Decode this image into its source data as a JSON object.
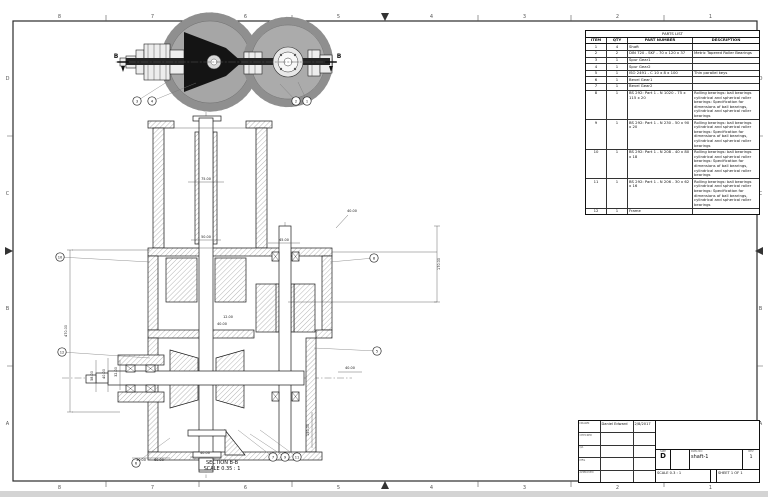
{
  "sheet": {
    "zones_top": [
      "8",
      "7",
      "6",
      "5",
      "4",
      "3",
      "2",
      "1"
    ],
    "zones_side": [
      "D",
      "C",
      "B",
      "A"
    ]
  },
  "top_view": {
    "section_label": "B",
    "balloons": [
      {
        "n": "3",
        "x": 137,
        "y": 101,
        "tx": 170,
        "ty": 80
      },
      {
        "n": "4",
        "x": 152,
        "y": 101,
        "tx": 196,
        "ty": 83
      },
      {
        "n": "2",
        "x": 296,
        "y": 101,
        "tx": 280,
        "ty": 84
      },
      {
        "n": "1",
        "x": 307,
        "y": 101,
        "tx": 298,
        "ty": 82
      }
    ]
  },
  "section_view": {
    "title": "SECTION B-B",
    "scale": "SCALE 0.35 : 1",
    "balloons": [
      {
        "n": "10",
        "x": 60,
        "y": 257,
        "tx": 150,
        "ty": 262
      },
      {
        "n": "12",
        "x": 62,
        "y": 352,
        "tx": 150,
        "ty": 358
      },
      {
        "n": "8",
        "x": 374,
        "y": 258,
        "tx": 330,
        "ty": 262
      },
      {
        "n": "5",
        "x": 377,
        "y": 351,
        "tx": 314,
        "ty": 348
      },
      {
        "n": "7",
        "x": 273,
        "y": 457,
        "tx": 238,
        "ty": 430
      },
      {
        "n": "9",
        "x": 285,
        "y": 457,
        "tx": 250,
        "ty": 434
      },
      {
        "n": "11",
        "x": 297,
        "y": 457,
        "tx": 260,
        "ty": 430
      },
      {
        "n": "6",
        "x": 136,
        "y": 463,
        "tx": 170,
        "ty": 438
      }
    ],
    "dim_labels": [
      {
        "t": "75.00",
        "x": 206,
        "y": 180,
        "r": 0
      },
      {
        "t": "50.00",
        "x": 206,
        "y": 238,
        "r": 0
      },
      {
        "t": "12.00",
        "x": 228,
        "y": 318,
        "r": 0
      },
      {
        "t": "40.00",
        "x": 222,
        "y": 325,
        "r": 0
      },
      {
        "t": "40.00",
        "x": 352,
        "y": 212,
        "r": 0
      },
      {
        "t": "45.00",
        "x": 284,
        "y": 241,
        "r": 0
      },
      {
        "t": "170.00",
        "x": 440,
        "y": 264,
        "r": -90
      },
      {
        "t": "470.00",
        "x": 67,
        "y": 331,
        "r": -90
      },
      {
        "t": "40.00",
        "x": 105,
        "y": 374,
        "r": -90
      },
      {
        "t": "32.00",
        "x": 117,
        "y": 372,
        "r": -90
      },
      {
        "t": "58.00",
        "x": 93,
        "y": 376,
        "r": -90
      },
      {
        "t": "150.00",
        "x": 309,
        "y": 430,
        "r": -90
      },
      {
        "t": "40.00",
        "x": 350,
        "y": 369,
        "r": 0
      },
      {
        "t": "40.00",
        "x": 205,
        "y": 454,
        "r": 0
      },
      {
        "t": "30.00",
        "x": 141,
        "y": 461,
        "r": 0
      },
      {
        "t": "60.00",
        "x": 159,
        "y": 461,
        "r": 0
      }
    ]
  },
  "parts_list": {
    "title": "PARTS LIST",
    "columns": [
      "ITEM",
      "QTY",
      "PART NUMBER",
      "DESCRIPTION"
    ],
    "rows": [
      {
        "item": "1",
        "qty": "4",
        "part_number": "Shaft",
        "description": ""
      },
      {
        "item": "2",
        "qty": "2",
        "part_number": "DIN 720 - SKF - 70 x 120 x 37",
        "description": "Metric Tapered Roller Bearings"
      },
      {
        "item": "3",
        "qty": "1",
        "part_number": "Spur Gear1",
        "description": ""
      },
      {
        "item": "4",
        "qty": "1",
        "part_number": "Spur Gear2",
        "description": ""
      },
      {
        "item": "5",
        "qty": "1",
        "part_number": "ISO 2491 - C 10 x 8 x 100",
        "description": "Thin parallel keys"
      },
      {
        "item": "6",
        "qty": "1",
        "part_number": "Bevel Gear1",
        "description": ""
      },
      {
        "item": "7",
        "qty": "1",
        "part_number": "Bevel Gear2",
        "description": ""
      },
      {
        "item": "8",
        "qty": "1",
        "part_number": "BS 292: Part 1 - N 1020 - 75 x 115 x 20",
        "description": "Rolling bearings: ball bearings cylindrical and spherical roller bearings: Specification for dimensions of ball bearings, cylindrical and spherical roller bearings"
      },
      {
        "item": "9",
        "qty": "1",
        "part_number": "BS 292: Part 1 - N 230 - 50 x 90 x 20",
        "description": "Rolling bearings: ball bearings cylindrical and spherical roller bearings: Specification for dimensions of ball bearings, cylindrical and spherical roller bearings"
      },
      {
        "item": "10",
        "qty": "1",
        "part_number": "BS 292: Part 1 - N 208 - 40 x 80 x 18",
        "description": "Rolling bearings: ball bearings cylindrical and spherical roller bearings: Specification for dimensions of ball bearings, cylindrical and spherical roller bearings"
      },
      {
        "item": "11",
        "qty": "1",
        "part_number": "BS 292: Part 1 - N 206 - 30 x 62 x 16",
        "description": "Rolling bearings: ball bearings cylindrical and spherical roller bearings: Specification for dimensions of ball bearings, cylindrical and spherical roller bearings"
      },
      {
        "item": "12",
        "qty": "1",
        "part_number": "Frame",
        "description": ""
      }
    ]
  },
  "title_block": {
    "drawn_name": "Daniel Edward",
    "drawn_date": "2/8/2017",
    "row_labels": [
      "DRAWN",
      "CHECKED",
      "QA",
      "MFG",
      "APPROVED"
    ],
    "size_label": "SIZE",
    "size": "D",
    "dwg_label": "DWG NO",
    "dwg_no": "shaft-1",
    "rev_label": "REV",
    "rev": "1",
    "scale_text": "SCALE  0.3 : 1",
    "sheet_text": "SHEET 1 OF 1"
  }
}
